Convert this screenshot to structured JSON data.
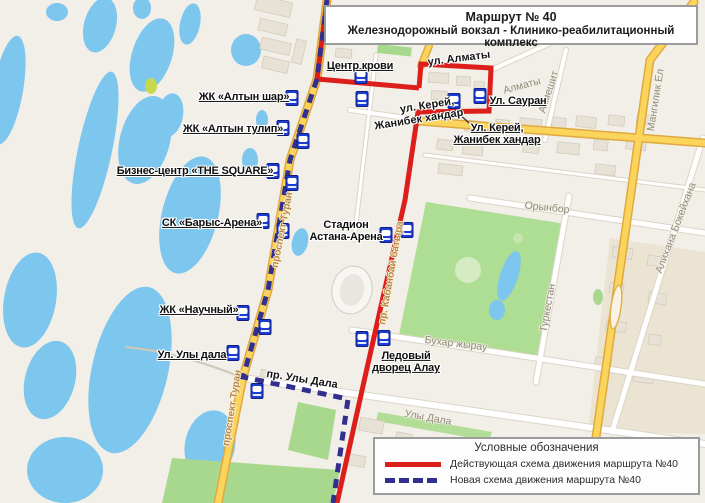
{
  "title": {
    "line1": "Маршрут № 40",
    "line2": "Железнодорожный вокзал - Клинико-реабилитационный комплекс"
  },
  "legend": {
    "title": "Условные обозначения",
    "items": [
      {
        "style": "solid",
        "color": "#dd1f1c",
        "label": "Действующая схема движения маршрута №40"
      },
      {
        "style": "dashed",
        "color": "#312f8f",
        "label": "Новая схема движения маршрута №40"
      }
    ]
  },
  "map": {
    "routes": [
      {
        "name": "current-route",
        "color": "#dd1f1c",
        "dash": "",
        "width": 5,
        "segments": [
          [
            [
              327,
              0
            ],
            [
              317,
              79
            ],
            [
              419,
              88
            ]
          ],
          [
            [
              419,
              88
            ],
            [
              421,
              64
            ],
            [
              491,
              68
            ],
            [
              489,
              111
            ],
            [
              418,
              112
            ],
            [
              405,
              200
            ],
            [
              365,
              377
            ],
            [
              337,
              503
            ]
          ]
        ]
      },
      {
        "name": "new-route",
        "color": "#312f8f",
        "dash": "9 7",
        "width": 5,
        "segments": [
          [
            [
              327,
              0
            ],
            [
              317,
              79
            ]
          ],
          [
            [
              317,
              79
            ],
            [
              290,
              160
            ],
            [
              268,
              290
            ],
            [
              243,
              377
            ],
            [
              348,
              399
            ],
            [
              333,
              503
            ]
          ]
        ]
      }
    ],
    "callout": [
      [
        455,
        110
      ],
      [
        469,
        123
      ]
    ],
    "bus_stops": [
      {
        "x": 361,
        "y": 76
      },
      {
        "x": 362,
        "y": 99
      },
      {
        "x": 454,
        "y": 101
      },
      {
        "x": 480,
        "y": 96
      },
      {
        "x": 292,
        "y": 98
      },
      {
        "x": 283,
        "y": 128
      },
      {
        "x": 303,
        "y": 141
      },
      {
        "x": 273,
        "y": 171
      },
      {
        "x": 292,
        "y": 183
      },
      {
        "x": 263,
        "y": 221
      },
      {
        "x": 283,
        "y": 231
      },
      {
        "x": 243,
        "y": 313
      },
      {
        "x": 265,
        "y": 327
      },
      {
        "x": 233,
        "y": 353
      },
      {
        "x": 257,
        "y": 391
      },
      {
        "x": 407,
        "y": 230
      },
      {
        "x": 386,
        "y": 235
      },
      {
        "x": 362,
        "y": 339
      },
      {
        "x": 384,
        "y": 338
      }
    ],
    "stop_labels": [
      {
        "text": "Центр крови",
        "x": 360,
        "y": 66,
        "underline": true
      },
      {
        "text": "ЖК «Алтын шар»",
        "x": 244,
        "y": 97,
        "underline": true
      },
      {
        "text": "ЖК «Алтын тулип»",
        "x": 233,
        "y": 129,
        "underline": true
      },
      {
        "text": "Бизнес-центр «THE SQUARE»",
        "x": 195,
        "y": 171,
        "underline": true
      },
      {
        "text": "СК «Барыс-Арена»",
        "x": 212,
        "y": 223,
        "underline": true
      },
      {
        "text": "ЖК «Научный»",
        "x": 199,
        "y": 310,
        "underline": true
      },
      {
        "text": "Ул. Улы дала",
        "x": 192,
        "y": 355,
        "underline": true
      },
      {
        "text": "Стадион\nАстана-Арена",
        "x": 346,
        "y": 231,
        "underline": false
      },
      {
        "text": "Ледовый\nдворец Алау",
        "x": 406,
        "y": 362,
        "underline": true
      },
      {
        "text": "Ул. Сауран",
        "x": 518,
        "y": 101,
        "underline": true
      },
      {
        "text": "Ул. Керей,\nЖанибек хандар",
        "x": 497,
        "y": 134,
        "underline": true
      }
    ],
    "street_labels": [
      {
        "text": "ул. Алматы",
        "x": 459,
        "y": 59,
        "rot": -7,
        "cls": "route-street"
      },
      {
        "text": "ул. Керей,",
        "x": 427,
        "y": 106,
        "rot": -9,
        "cls": "route-street"
      },
      {
        "text": "Жанибек хандар",
        "x": 419,
        "y": 120,
        "rot": -9,
        "cls": "route-street"
      },
      {
        "text": "пр. Улы Дала",
        "x": 302,
        "y": 380,
        "rot": 9,
        "cls": "route-street"
      },
      {
        "text": "проспект Туран",
        "x": 283,
        "y": 230,
        "rot": -79,
        "cls": "road-label"
      },
      {
        "text": "проспект Туран",
        "x": 233,
        "y": 408,
        "rot": -81,
        "cls": "road-label"
      },
      {
        "text": "пр. Кабанбай батыра",
        "x": 392,
        "y": 273,
        "rot": -80,
        "cls": "road-label"
      },
      {
        "text": "Алматы",
        "x": 522,
        "y": 86,
        "rot": -15,
        "cls": "map-street"
      },
      {
        "text": "Акмешит",
        "x": 549,
        "y": 92,
        "rot": -72,
        "cls": "map-street"
      },
      {
        "text": "Мангилик Ел",
        "x": 656,
        "y": 100,
        "rot": -81,
        "cls": "map-street"
      },
      {
        "text": "Орынбор",
        "x": 547,
        "y": 208,
        "rot": 6,
        "cls": "map-street"
      },
      {
        "text": "Туркестан",
        "x": 548,
        "y": 308,
        "rot": -80,
        "cls": "map-street"
      },
      {
        "text": "Алихана Бокейхана",
        "x": 676,
        "y": 228,
        "rot": -69,
        "cls": "map-street"
      },
      {
        "text": "Бухар жырау",
        "x": 456,
        "y": 344,
        "rot": 7,
        "cls": "map-street"
      },
      {
        "text": "Улы Дала",
        "x": 428,
        "y": 418,
        "rot": 10,
        "cls": "map-street"
      }
    ]
  }
}
